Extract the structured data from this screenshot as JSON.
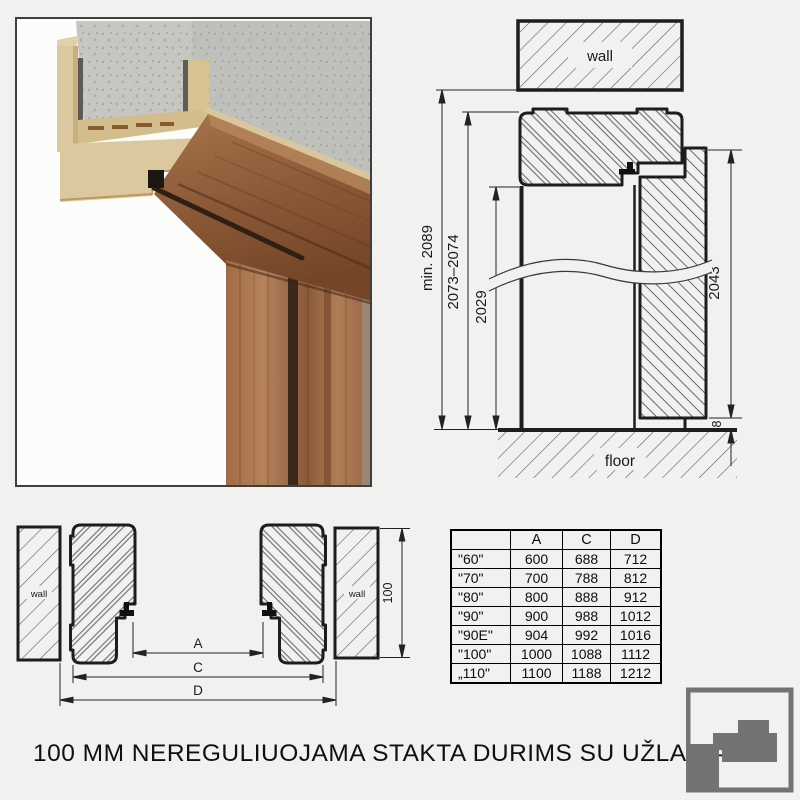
{
  "caption": "100 MM NEREGULIUOJAMA STAKTA DURIMS SU UŽLAIDA",
  "colors": {
    "line": "#1d1d1d",
    "hatch": "#636363",
    "logo_gray": "#737373",
    "mdf_beige": "#dcc89e",
    "wood_brown": "#8f5f3c",
    "concrete_gray": "#c6c7c3"
  },
  "vertical_section": {
    "wall_label": "wall",
    "floor_label": "floor",
    "dim_min_height": "min. 2089",
    "dim_frame_height": "2073–2074",
    "dim_opening_height": "2029",
    "dim_leaf_height": "2043",
    "dim_floor_gap": "8"
  },
  "horizontal_section": {
    "left_wall_label": "wall",
    "right_wall_label": "wall",
    "dim_a": "A",
    "dim_c": "C",
    "dim_d": "D",
    "dim_depth": "100"
  },
  "size_table": {
    "headers": [
      "",
      "A",
      "C",
      "D"
    ],
    "rows": [
      {
        "size": "\"60\"",
        "a": "600",
        "c": "688",
        "d": "712"
      },
      {
        "size": "\"70\"",
        "a": "700",
        "c": "788",
        "d": "812"
      },
      {
        "size": "\"80\"",
        "a": "800",
        "c": "888",
        "d": "912"
      },
      {
        "size": "\"90\"",
        "a": "900",
        "c": "988",
        "d": "1012"
      },
      {
        "size": "\"90E\"",
        "a": "904",
        "c": "992",
        "d": "1016"
      },
      {
        "size": "\"100\"",
        "a": "1000",
        "c": "1088",
        "d": "1112"
      },
      {
        "size": "„110\"",
        "a": "1100",
        "c": "1188",
        "d": "1212"
      }
    ]
  }
}
